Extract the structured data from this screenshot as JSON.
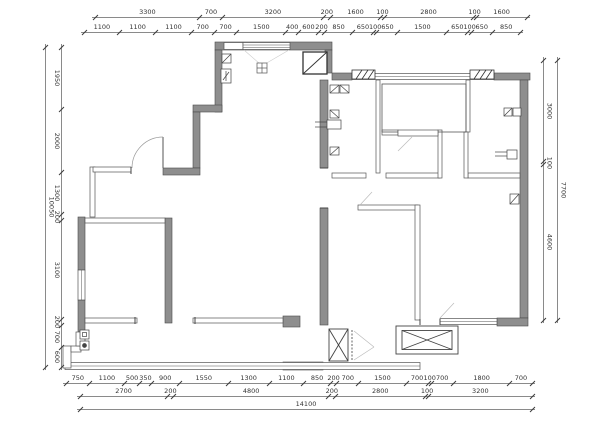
{
  "colors": {
    "background": "#ffffff",
    "wall_fill": "#8e8e8e",
    "wall_outline": "#4a4a4a",
    "thin_line": "#555555",
    "dim_line": "#8a8a8a",
    "dim_text": "#333333",
    "light_line": "#bbbbbb"
  },
  "dimensions": {
    "top_row1": [
      "3300",
      "700",
      "3200",
      "200",
      "1600",
      "100",
      "2800",
      "100",
      "1600"
    ],
    "top_row2": [
      "1100",
      "1100",
      "1100",
      "700",
      "700",
      "1500",
      "400",
      "600",
      "200",
      "850",
      "650",
      "100",
      "650",
      "1500",
      "650",
      "100",
      "650",
      "850"
    ],
    "left_outer": [
      "10050"
    ],
    "left_inner": [
      "1950",
      "2000",
      "1300",
      "200",
      "3100",
      "200",
      "700",
      "600"
    ],
    "right_inner": [
      "3000",
      "100",
      "4600"
    ],
    "right_outer": [
      "7700"
    ],
    "bottom_row1": [
      "750",
      "1100",
      "500",
      "350",
      "900",
      "1550",
      "1300",
      "1100",
      "850",
      "200",
      "700",
      "1500",
      "700",
      "100",
      "700",
      "1800",
      "700"
    ],
    "bottom_row2": [
      "2700",
      "200",
      "4800",
      "200",
      "2800",
      "100",
      "3200"
    ],
    "bottom_row3": [
      "14100"
    ]
  }
}
